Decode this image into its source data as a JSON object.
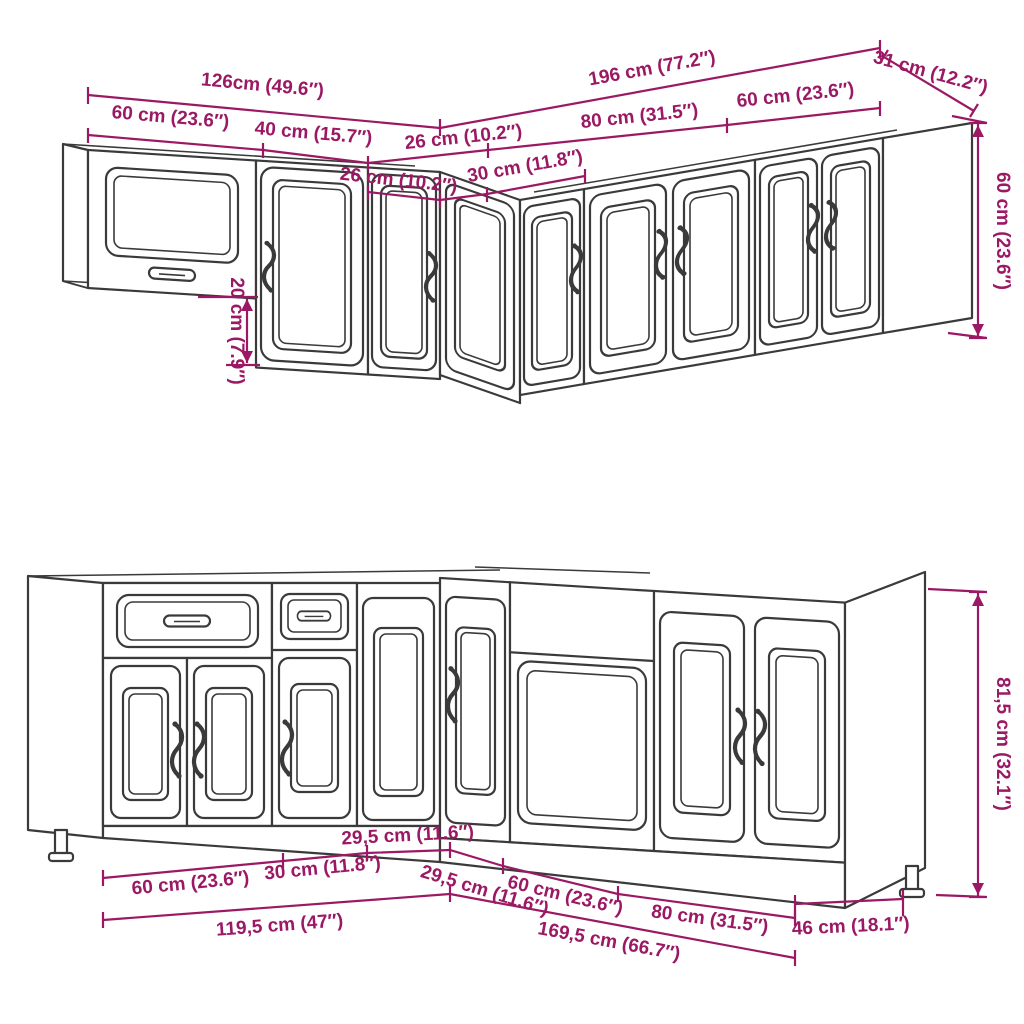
{
  "diagram": {
    "background_color": "#ffffff",
    "outline_color": "#3a3a3a",
    "dimension_color": "#9b1964",
    "subject": "L-shaped kitchen cabinet set, dimensioned line drawing"
  },
  "wall_assembly": {
    "dims": {
      "total_left": "126cm (49.6″)",
      "total_right": "196 cm (77.2″)",
      "side_depth": "31 cm (12.2″)",
      "cab_60_left": "60 cm (23.6″)",
      "cab_40": "40 cm (15.7″)",
      "cab_26_left": "26 cm (10.2″)",
      "cab_26_corner": "26 cm (10.2″)",
      "cab_30": "30 cm (11.8″)",
      "cab_80": "80 cm (31.5″)",
      "cab_60_right": "60 cm (23.6″)",
      "height_right": "60 cm (23.6″)",
      "underhang_left": "20 cm (7.9″)"
    }
  },
  "base_assembly": {
    "dims": {
      "cab_60_left": "60 cm (23.6″)",
      "cab_30": "30 cm (11.8″)",
      "cab_295_left": "29,5 cm (11.6″)",
      "cab_295_right": "29,5 cm (11.6″)",
      "cab_60_right": "60 cm (23.6″)",
      "cab_80": "80 cm (31.5″)",
      "total_left": "119,5 cm (47″)",
      "total_right": "169,5 cm (66.7″)",
      "side_depth": "46 cm (18.1″)",
      "height_right": "81,5 cm (32.1″)"
    }
  }
}
